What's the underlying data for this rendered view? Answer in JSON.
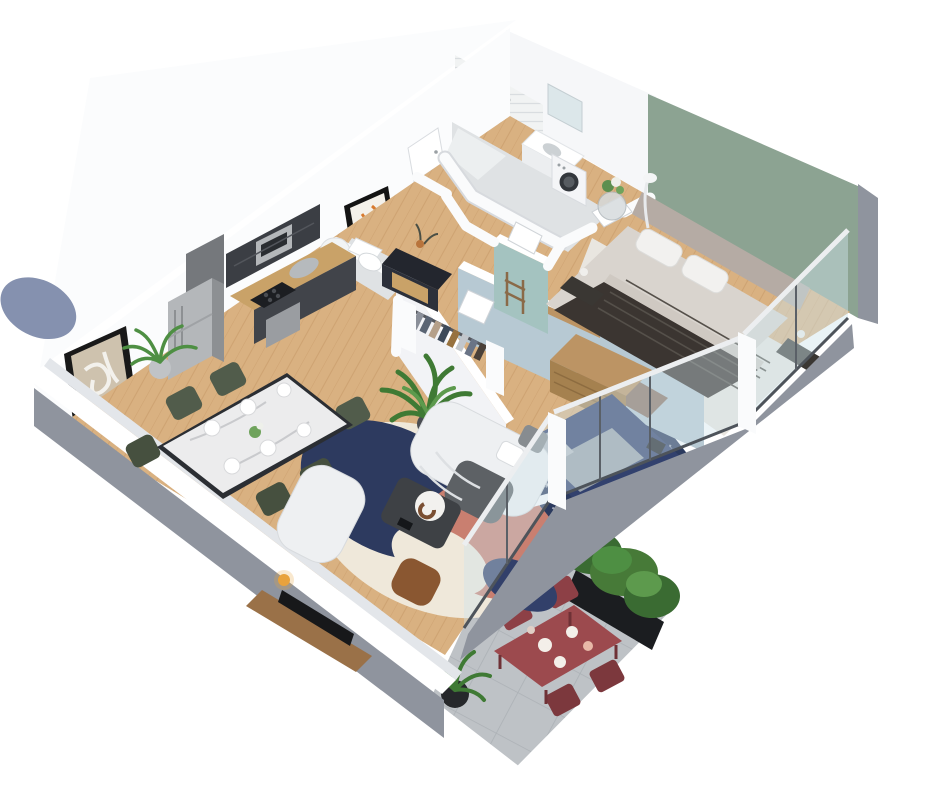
{
  "scene": {
    "type": "3d-floor-plan-render",
    "style": "isometric-cutaway-apartment",
    "background": "#ffffff"
  },
  "palette": {
    "wall_white": "#f6f7f9",
    "wall_lit": "#fbfcfd",
    "wall_cap": "#ffffff",
    "wall_shadow": "#d7dade",
    "outer_gray": "#8f949e",
    "outer_gray_dark": "#7a7f89",
    "accent_sage": "#8ca392",
    "accent_bluegray": "#b7c9d3",
    "accent_teal": "#a4c3c0",
    "floor_wood": "#d9b181",
    "bath_floor": "#dfe2e4",
    "tile_white": "#f1f3f3",
    "terrace_concrete": "#bec2c6",
    "glass_tint": "#cfe4ec",
    "frame_dark": "#4e545b",
    "rug_navy": "#2d3a5f",
    "rug_terracotta": "#c97f70",
    "rug_cream": "#efe8da",
    "rug_slate": "#8591af",
    "sofa_white": "#eef0f2",
    "throw_gray": "#5d6165",
    "leather_brown": "#8a5731",
    "coffee_table": "#3e4145",
    "master_rug": "#e9e6e0",
    "master_duvet": "#3b3531",
    "master_mattress": "#d9d4ce",
    "headboard_taupe": "#b5aba4",
    "bench_brown": "#8b7263",
    "nightstand_dark": "#3a3733",
    "bed2_navy": "#32416e",
    "bed2_blanket": "#9aa2aa",
    "bed2_rug": "#2b3a5e",
    "dresser_wood": "#bc9464",
    "marble_white": "#ececed",
    "chair_green": "#515c4b",
    "terrace_table_red": "#9c4a4e",
    "terrace_chair_red": "#8d4046",
    "plant_green": "#4e8f43",
    "plant_green_dark": "#3a6b32",
    "planter_black": "#1b1d20",
    "kitchen_dark": "#3b3e44",
    "counter_wood": "#c9a268",
    "steel": "#b4b7ba",
    "art_beige": "#cec2ae",
    "art_orange": "#d87a2e"
  },
  "rooms": [
    {
      "id": "bathroom",
      "features": [
        "shower",
        "vanity-sink",
        "mirror",
        "washing-machine",
        "tiled-wall"
      ]
    },
    {
      "id": "wc",
      "features": [
        "toilet",
        "water-heater",
        "framed-art"
      ]
    },
    {
      "id": "hallway",
      "features": [
        "console-sideboard",
        "vase",
        "doors"
      ]
    },
    {
      "id": "walk-in-closet",
      "features": [
        "clothes-rail",
        "hanging-clothes"
      ]
    },
    {
      "id": "master-bedroom",
      "accent_wall": "#8ca392",
      "features": [
        "double-bed",
        "headboard",
        "nightstands",
        "bench",
        "side-table-flowers",
        "floor-lamp",
        "cream-rug"
      ]
    },
    {
      "id": "bedroom-2",
      "accent_wall": "#b7c9d3",
      "features": [
        "single-bed",
        "navy-rug",
        "dresser",
        "wall-shelf"
      ]
    },
    {
      "id": "kitchen",
      "features": [
        "fridge",
        "upper-cabinets",
        "microwave",
        "sink",
        "cooktop",
        "oven",
        "palm-plant"
      ]
    },
    {
      "id": "living-dining-room",
      "features": [
        "dining-table-marble",
        "six-chairs",
        "white-sofa",
        "armchair",
        "coffee-table",
        "leather-pouf",
        "abstract-rug",
        "tv-sideboard",
        "tv",
        "large-plant",
        "framed-art"
      ]
    },
    {
      "id": "terrace",
      "features": [
        "concrete-tiles",
        "red-dining-table",
        "four-red-chairs",
        "hedge-planter",
        "potted-plant"
      ]
    }
  ]
}
